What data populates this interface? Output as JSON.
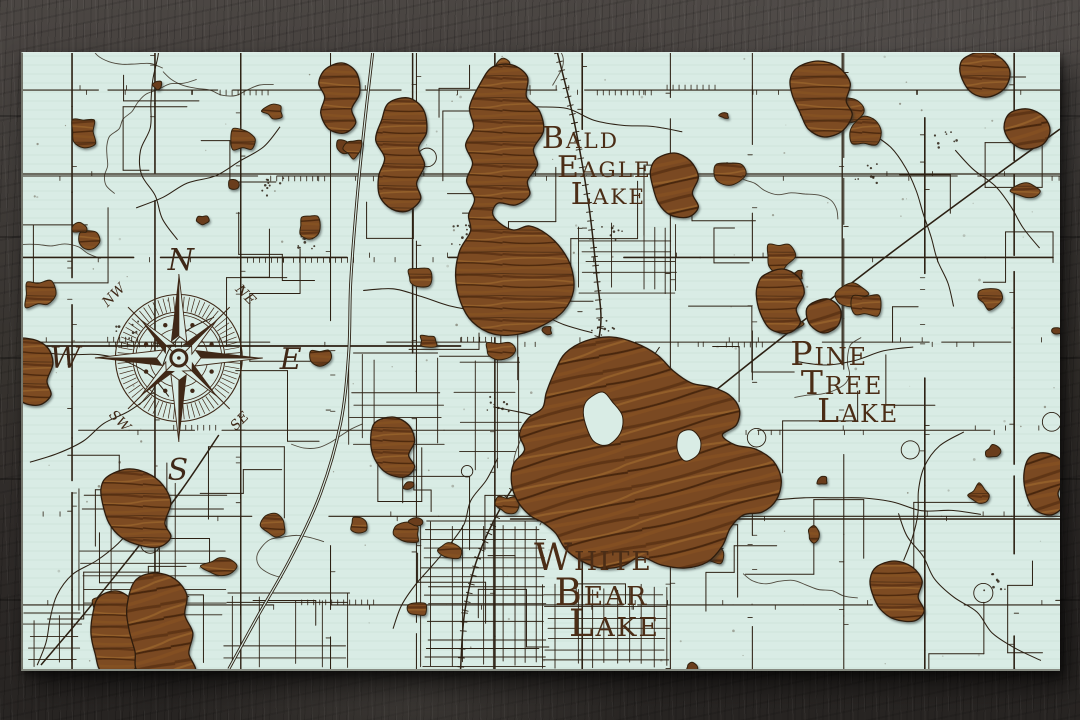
{
  "labels": {
    "bald_eagle": [
      "Bald",
      "Eagle",
      "Lake"
    ],
    "pine_tree": [
      "Pine",
      "Tree",
      "Lake"
    ],
    "white_bear": [
      "White",
      "Bear",
      "Lake"
    ]
  },
  "compass": {
    "cardinal": [
      "N",
      "E",
      "S",
      "W"
    ],
    "ordinal": [
      "NE",
      "NW",
      "SE",
      "SW"
    ]
  },
  "colors": {
    "panel_mint": "#d9ece5",
    "road_ink": "#2c2013",
    "label_brown": "#4b2d16",
    "compass_brown": "#3f2817",
    "walnut_base": "#7d4b22",
    "walnut_dark": "#46260e",
    "walnut_light": "#96622e",
    "backdrop_wood": "#3a3532"
  }
}
